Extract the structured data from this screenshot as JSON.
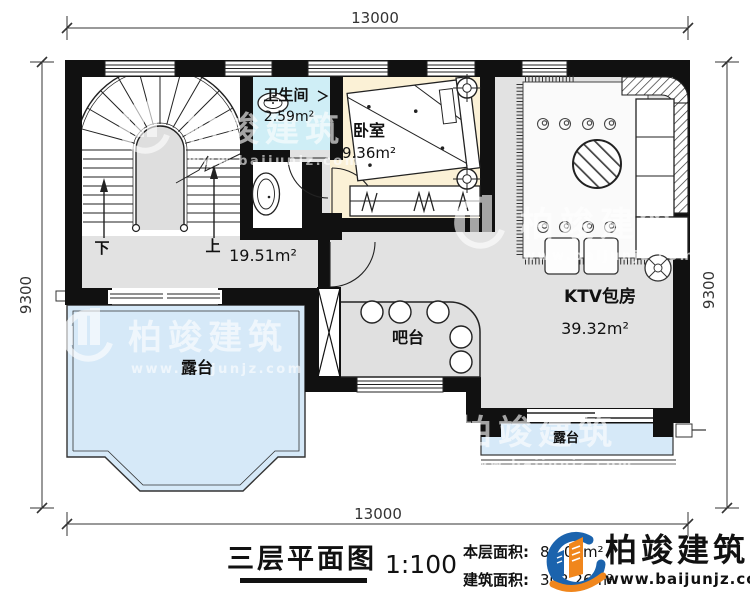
{
  "plan_title": "三层平面图",
  "scale": "1:100",
  "areas": {
    "floor_label": "本层面积:",
    "floor_value": "84.05m²",
    "building_label": "建筑面积:",
    "building_value": "302.26m²"
  },
  "dimensions": {
    "top": "13000",
    "bottom": "13000",
    "left": "9300",
    "right": "9300"
  },
  "rooms": {
    "bathroom": {
      "name": "卫生间",
      "area": "2.59m²"
    },
    "bedroom": {
      "name": "卧室",
      "area": "9.36m²"
    },
    "ktv": {
      "name": "KTV包房",
      "area": "39.32m²"
    },
    "bar": {
      "name": "吧台"
    },
    "hall": {
      "area": "19.51m²"
    },
    "terrace_left": {
      "name": "露台"
    },
    "terrace_right": {
      "name": "露台"
    }
  },
  "stairs": {
    "down": "下",
    "up": "上"
  },
  "branding": {
    "company": "柏竣建筑",
    "website": "www.baijunjz.com"
  },
  "watermark": {
    "company": "柏竣建筑",
    "website": "www.baijunjz.com"
  },
  "colors": {
    "wall": "#111111",
    "floor_gray": "#e2e2e2",
    "terrace_blue": "#d6e9f8",
    "bathroom_cyan": "#cfeef6",
    "bedroom_cream": "#fbf1d6",
    "logo_blue": "#1b63ad",
    "logo_orange": "#f0861c"
  }
}
